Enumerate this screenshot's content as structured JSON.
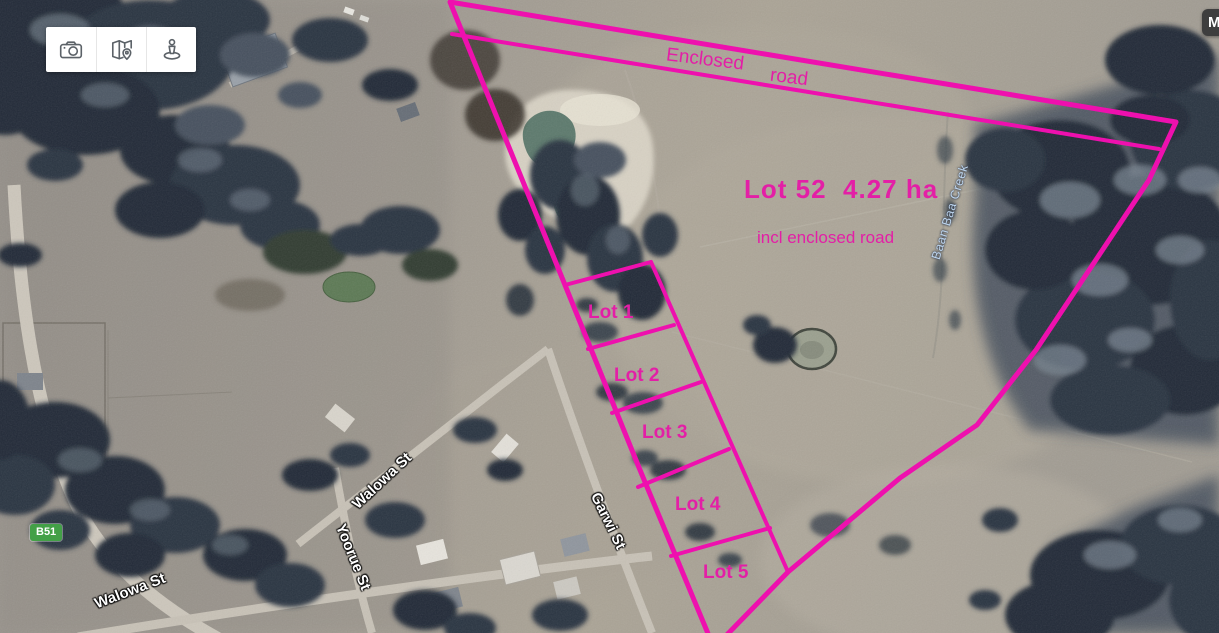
{
  "colors": {
    "boundary_pink": "#ee10ae",
    "label_pink": "#e31fa6",
    "route_badge_green": "#43a047",
    "creek_label_blue": "#bdd5ee",
    "control_button_bg": "#ffffff",
    "corner_button_bg": "#3e3e3e"
  },
  "toolbar": {
    "buttons": [
      {
        "name": "camera",
        "icon": "camera-icon"
      },
      {
        "name": "map-location",
        "icon": "map-location-icon"
      },
      {
        "name": "street-view",
        "icon": "street-view-icon"
      }
    ]
  },
  "corner_button": {
    "label": "M"
  },
  "route_badge": {
    "label": "B51"
  },
  "overlay": {
    "enclosed_road_word1": "Enclosed",
    "enclosed_road_word2": "road",
    "lot52_title": "Lot 52  4.27 ha",
    "lot52_subtitle": "incl enclosed road",
    "lots": [
      {
        "label": "Lot 1"
      },
      {
        "label": "Lot 2"
      },
      {
        "label": "Lot 3"
      },
      {
        "label": "Lot 4"
      },
      {
        "label": "Lot 5"
      }
    ]
  },
  "streets": {
    "walowa_upper": "Walowa St",
    "walowa_lower": "Walowa St",
    "yoorue": "Yoorue St",
    "garwi": "Garwi St"
  },
  "water": {
    "creek_label": "Baan Baa Creek"
  }
}
